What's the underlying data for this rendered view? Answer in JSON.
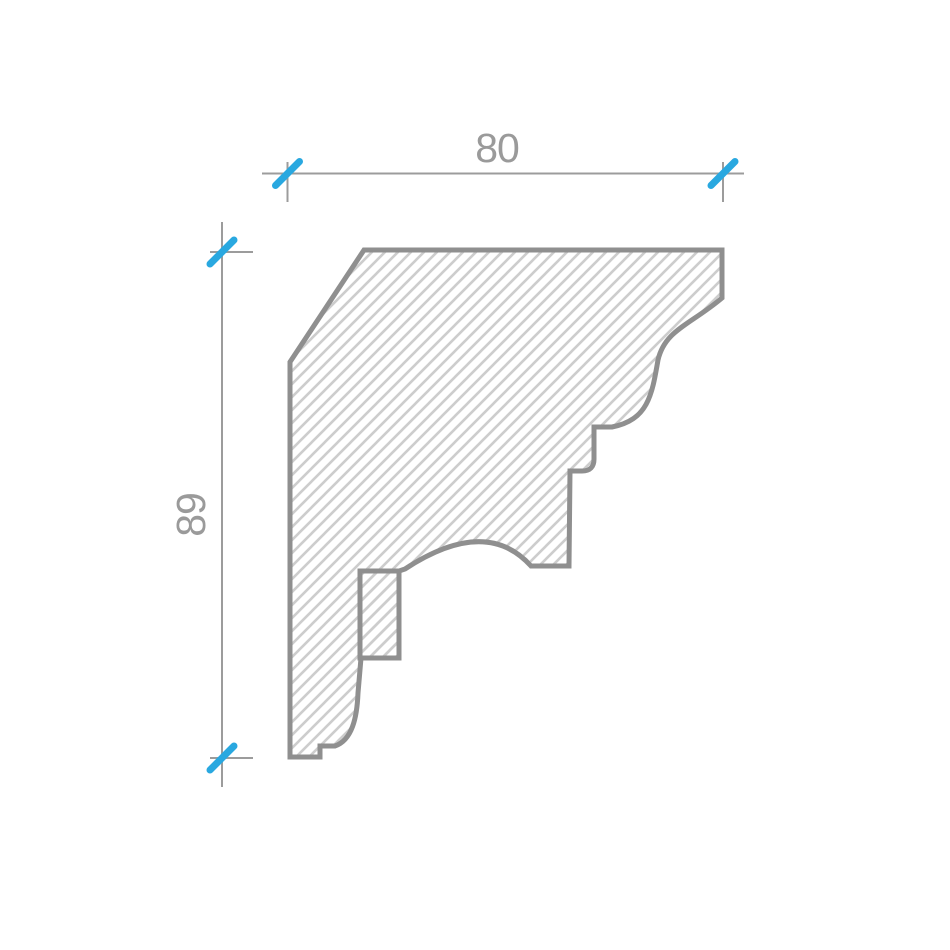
{
  "diagram": {
    "kind": "cornice-profile-cross-section",
    "dimensions": {
      "width": {
        "label": "80"
      },
      "height": {
        "label": "89"
      }
    },
    "colors": {
      "background": "#ffffff",
      "outline": "#8f8f8f",
      "hatch": "#cdcdcd",
      "dim_line": "#9c9c9c",
      "dim_text": "#9a9a9a",
      "accent": "#29a8e0"
    }
  }
}
